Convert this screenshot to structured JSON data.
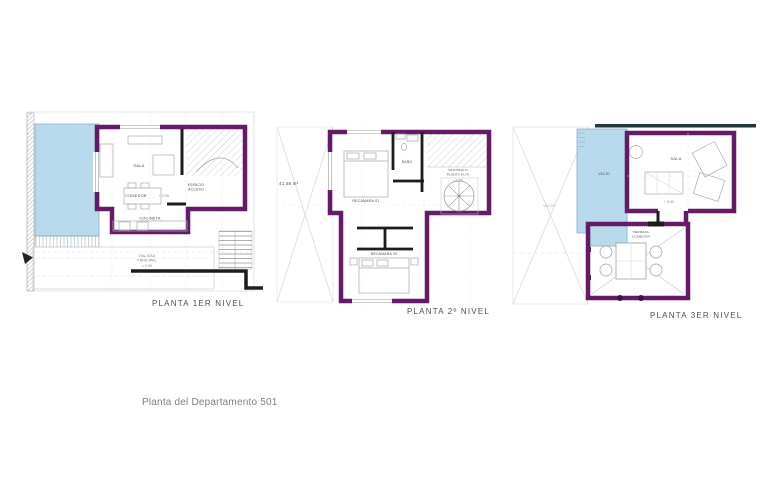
{
  "caption": "Planta del Departamento 501",
  "colors": {
    "wall_purple": "#641b66",
    "wall_black": "#1c1c1c",
    "pool_blue": "#b9d9ec",
    "top_band": "#24383c",
    "title_gray": "#4f4f4f",
    "caption_gray": "#7f7f7f"
  },
  "plan1": {
    "title": "PLANTA 1ER NIVEL",
    "labels": {
      "sala": "SALA",
      "comedor": "COMEDOR",
      "comedor_level": "+ 0.05",
      "cocineta": "COCINETA",
      "acceso_line1": "ESPACIO",
      "acceso_line2": "ACCESO",
      "vialidad_line1": "VIALIDAD",
      "vialidad_line2": "PRINCIPAL",
      "vialidad_level": "± 0.00"
    }
  },
  "plan2": {
    "title": "PLANTA 2º NIVEL",
    "area": "41.48 m²",
    "labels": {
      "recamara1": "RECÁMARA 01",
      "bano": "BAÑO",
      "vestibulo_line1": "VESTÍBULO",
      "vestibulo_line2": "PLANTA ALTA",
      "vestibulo_level": "+ 2.80",
      "recamara2": "RECÁMARA 02"
    }
  },
  "plan3": {
    "title": "PLANTA 3ER NIVEL",
    "labels": {
      "vacio_side": "VACÍO",
      "vacio_blue": "VACÍO",
      "sala": "SALA",
      "sala_level": "+ 5.60",
      "terraza_line1": "TERRAZA",
      "terraza_line2": "COMEDOR"
    }
  }
}
